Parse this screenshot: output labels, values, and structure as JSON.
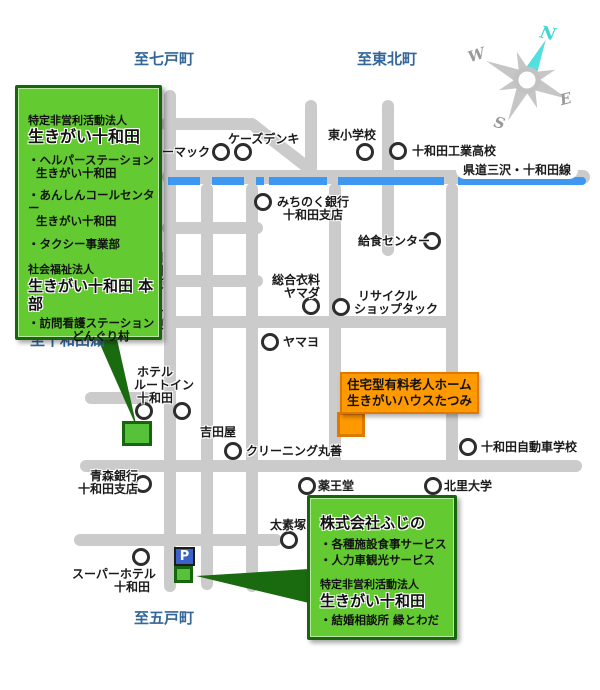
{
  "colors": {
    "road_gray": "#CBCBCB",
    "prefectural_route_blue": "#3E97F0",
    "info_box_green": "#63CB31",
    "info_box_border_green": "#17660D",
    "callout_orange": "#FF9900",
    "callout_border_orange": "#E07800",
    "parking_blue": "#3A62C8",
    "direction_text_blue": "#336699",
    "compass_needle_cyan": "#4FE0DF"
  },
  "compass": {
    "n": "N",
    "w": "W",
    "e": "E",
    "s": "S"
  },
  "directions": {
    "north_west": "至七戸町",
    "north_east": "至東北町",
    "west": "至十和田湖",
    "south": "至五戸町"
  },
  "road_labels": {
    "prefectural": "県道三沢・十和田線",
    "old_national": "旧国道4号線"
  },
  "parking": {
    "label": "P"
  },
  "tatsumi_callout": {
    "line1": "住宅型有料老人ホーム",
    "line2": "生きがいハウスたつみ"
  },
  "npo_box": {
    "org_type": "特定非営利活動法人",
    "org_name": "生きがい十和田",
    "b1l1": "・ヘルパーステーション",
    "b1l2": "生きがい十和田",
    "b2l1": "・あんしんコールセンター",
    "b2l2": "生きがい十和田",
    "b3": "・タクシー事業部",
    "org_type2": "社会福祉法人",
    "org_name2": "生きがい十和田 本部",
    "b4l1": "・訪問看護ステーション",
    "b4l2": "どんぐり村"
  },
  "fujino_box": {
    "name": "株式会社ふじの",
    "b1": "・各種施設食事サービス",
    "b2": "・人力車観光サービス",
    "org_type": "特定非営利活動法人",
    "org_name": "生きがい十和田",
    "b3": "・結婚相談所 縁とわだ"
  },
  "pois": [
    {
      "label": "ホーマック"
    },
    {
      "label": "ケーズデンキ"
    },
    {
      "label": "東小学校"
    },
    {
      "label": "十和田工業高校"
    },
    {
      "line1": "みちのく銀行",
      "line2": "十和田支店"
    },
    {
      "label": "給食センター"
    },
    {
      "line1": "総合衣料",
      "line2": "ヤマダ"
    },
    {
      "line1": "リサイクル",
      "line2": "ショップタック"
    },
    {
      "label": "ヤマヨ"
    },
    {
      "line1": "ホテル",
      "line2": "ルートイン",
      "line3": "十和田"
    },
    {
      "label": "吉田屋"
    },
    {
      "label": "クリーニング丸善"
    },
    {
      "label": "十和田自動車学校"
    },
    {
      "line1": "青森銀行",
      "line2": "十和田支店"
    },
    {
      "label": "薬王堂"
    },
    {
      "label": "北里大学"
    },
    {
      "label": "太素塚"
    },
    {
      "line1": "スーパーホテル",
      "line2": "十和田"
    }
  ]
}
